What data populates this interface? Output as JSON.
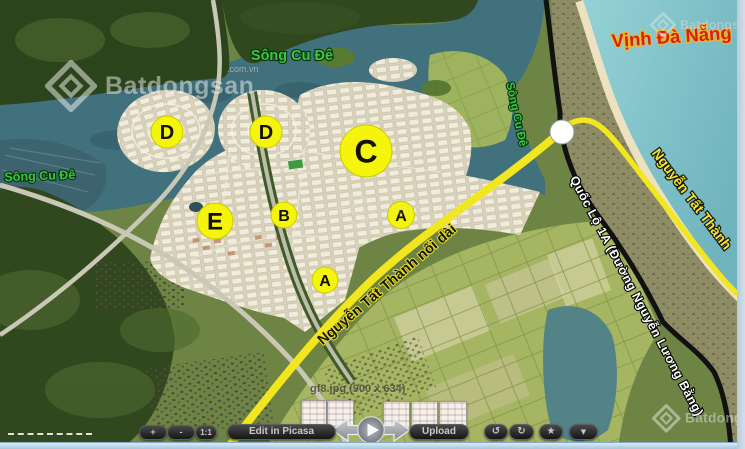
{
  "map": {
    "labels": {
      "song_cu_de_left": "Sông Cu Đê",
      "song_cu_de_top": "Sông Cu Đê",
      "song_cu_de_river": "Sông Cu Đê",
      "vinh_da_nang": "Vịnh Đà Nẵng",
      "nguyen_tat_thanh": "Nguyễn Tất Thành",
      "quoc_lo_1a": "Quốc Lộ 1A (Đường Nguyễn Lương Bằng)",
      "ntt_noi_dai": "Nguyễn Tất Thành nối dài"
    },
    "zones": [
      "D",
      "D",
      "C",
      "E",
      "B",
      "A",
      "A"
    ],
    "colors": {
      "road_yellow": "#f2e71f",
      "road_black": "#111111",
      "zone_circle": "#f4f40c",
      "river": "#41717d",
      "bay": "#7fc2ca",
      "label_green": "#3ec544",
      "label_red": "#d42114",
      "label_yellow": "#f2e430"
    }
  },
  "watermark": {
    "brand": "Batdongsan",
    "suffix": ".com.vn"
  },
  "viewer": {
    "caption": "gf8.jpg (900 x 634)",
    "buttons": {
      "zoom_in": "+",
      "zoom_out": "-",
      "actual_size": "1:1",
      "edit": "Edit in Picasa",
      "upload": "Upload",
      "rotate_left": "↺",
      "rotate_right": "↻",
      "star": "★",
      "more": "▼"
    }
  }
}
